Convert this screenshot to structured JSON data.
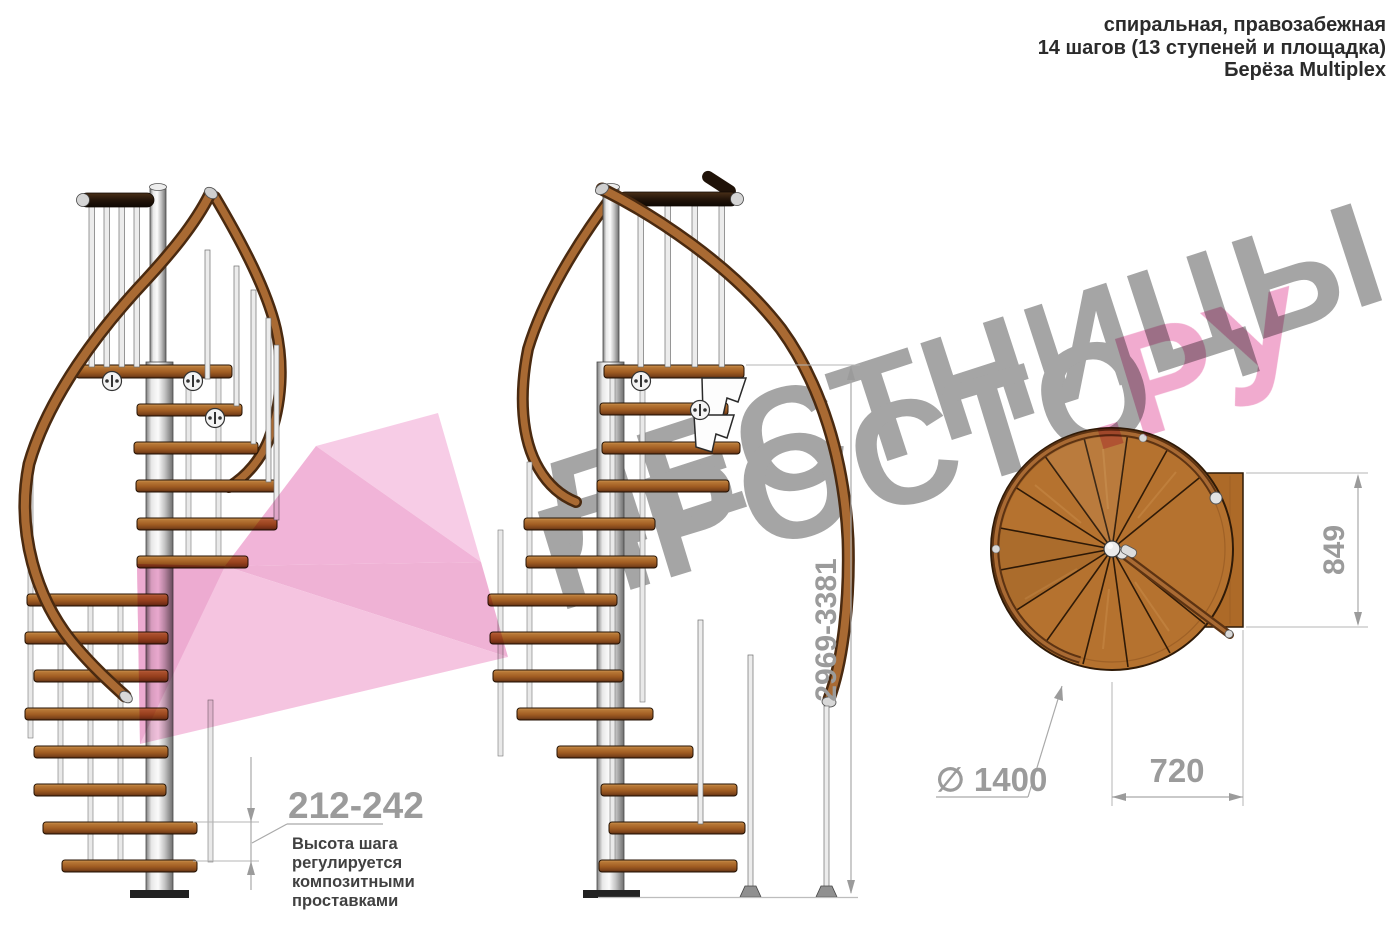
{
  "header": {
    "line1": "спиральная, правозабежная",
    "line2": "14 шагов (13 ступеней и площадка)",
    "line3": "Берёза Multiplex"
  },
  "watermark": {
    "brand_word1": "ЛЕСТНИЦЫ",
    "brand_word2": "ПРОСТО",
    "brand_tld": ".РУ",
    "gray": "#9e9e9e",
    "pink": "#ef9cc6",
    "arrow_pink": "#f4badb"
  },
  "annotations": {
    "step_height": {
      "value": "212-242",
      "note_line1": "Высота шага",
      "note_line2": "регулируется",
      "note_line3": "композитными",
      "note_line4": "проставками"
    },
    "total_height": {
      "value": "2969-3381"
    },
    "plan_depth": {
      "value": "849"
    },
    "plan_width": {
      "value": "720"
    },
    "plan_diameter": {
      "value": "∅ 1400"
    }
  },
  "materials": {
    "wood_color": "#b5722f",
    "steel_color": "#d9d9d9",
    "handrail_color": "#a96a33"
  }
}
